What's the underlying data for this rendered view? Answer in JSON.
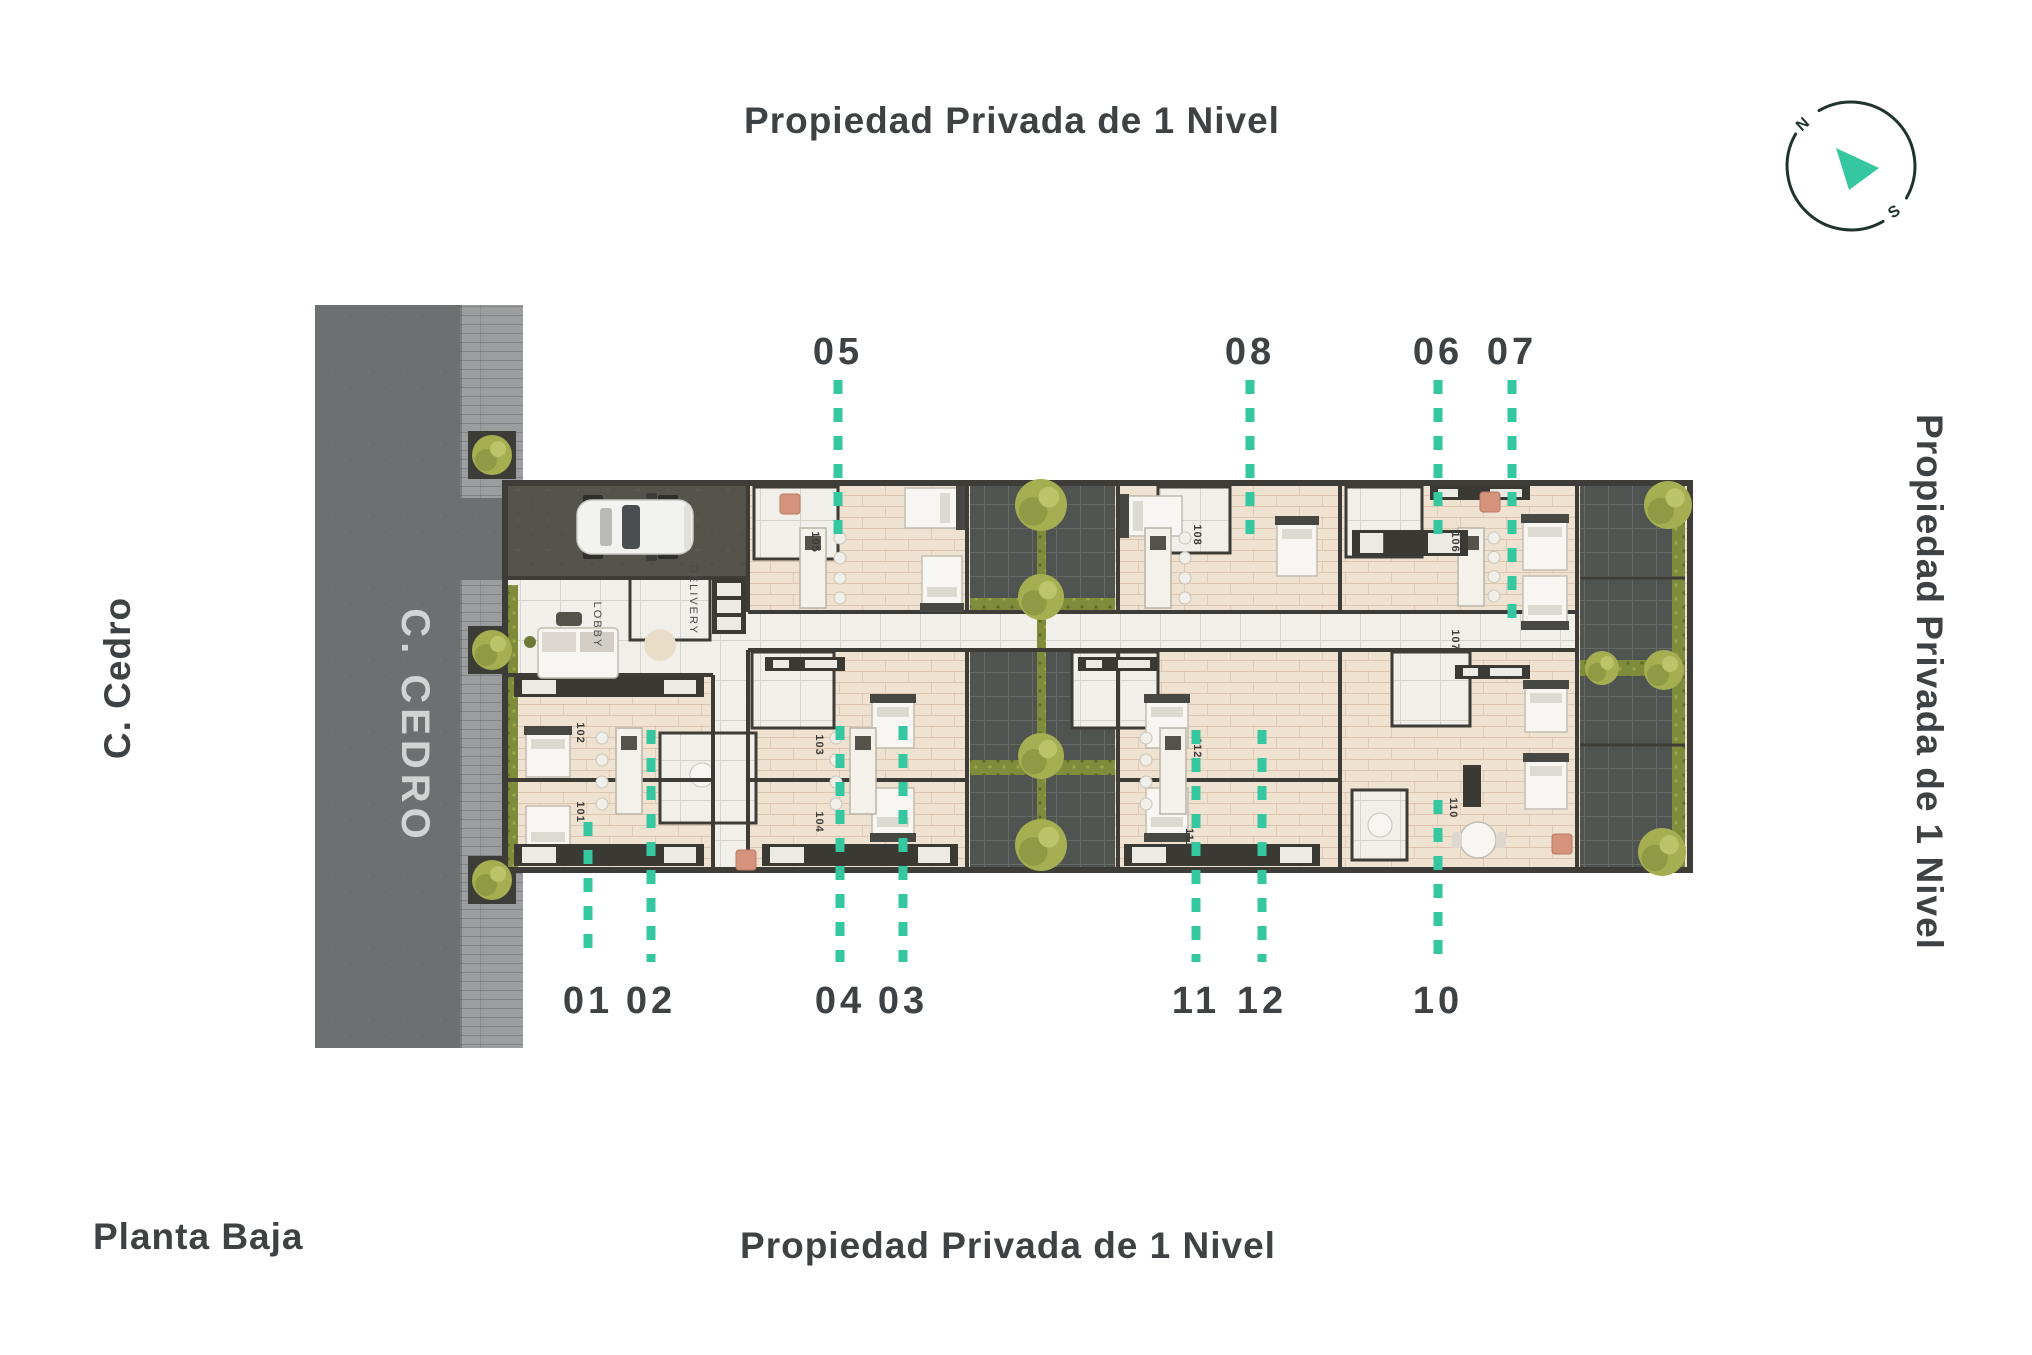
{
  "titles": {
    "top": "Propiedad Privada de 1 Nivel",
    "right": "Propiedad Privada de 1 Nivel",
    "bottom": "Propiedad Privada de 1 Nivel",
    "floor": "Planta Baja"
  },
  "street": {
    "name_outside": "C. Cedro",
    "name_road": "C. CEDRO"
  },
  "compass": {
    "north": "N",
    "south": "S"
  },
  "plan": {
    "lobby": "LOBBY",
    "delivery": "DELIVERY",
    "rooms": [
      {
        "n": "105",
        "x": 812,
        "y": 542
      },
      {
        "n": "108",
        "x": 1194,
        "y": 535
      },
      {
        "n": "106",
        "x": 1452,
        "y": 542
      },
      {
        "n": "107",
        "x": 1452,
        "y": 640
      },
      {
        "n": "110",
        "x": 1450,
        "y": 808
      },
      {
        "n": "102",
        "x": 577,
        "y": 733
      },
      {
        "n": "101",
        "x": 577,
        "y": 812
      },
      {
        "n": "103",
        "x": 816,
        "y": 745
      },
      {
        "n": "104",
        "x": 816,
        "y": 822
      },
      {
        "n": "112",
        "x": 1194,
        "y": 748
      },
      {
        "n": "111",
        "x": 1186,
        "y": 838
      }
    ],
    "callouts": [
      {
        "label": "05",
        "x": 838,
        "label_y": 364,
        "y1": 380,
        "y2": 545
      },
      {
        "label": "08",
        "x": 1250,
        "label_y": 364,
        "y1": 380,
        "y2": 545
      },
      {
        "label": "06",
        "x": 1438,
        "label_y": 364,
        "y1": 380,
        "y2": 538
      },
      {
        "label": "07",
        "x": 1512,
        "label_y": 364,
        "y1": 380,
        "y2": 618
      },
      {
        "label": "01",
        "x": 588,
        "label_y": 1013,
        "y1": 822,
        "y2": 962
      },
      {
        "label": "02",
        "x": 651,
        "label_y": 1013,
        "y1": 730,
        "y2": 962
      },
      {
        "label": "04",
        "x": 840,
        "label_y": 1013,
        "y1": 726,
        "y2": 962
      },
      {
        "label": "03",
        "x": 903,
        "label_y": 1013,
        "y1": 726,
        "y2": 962
      },
      {
        "label": "11",
        "x": 1196,
        "label_y": 1013,
        "y1": 730,
        "y2": 962
      },
      {
        "label": "12",
        "x": 1262,
        "label_y": 1013,
        "y1": 730,
        "y2": 962
      },
      {
        "label": "10",
        "x": 1438,
        "label_y": 1013,
        "y1": 800,
        "y2": 962
      }
    ]
  },
  "colors": {
    "teal": "#35c7a0",
    "ink": "#3f4245",
    "road_text": "#d2d4d4",
    "room_text": "#3a3a38"
  }
}
